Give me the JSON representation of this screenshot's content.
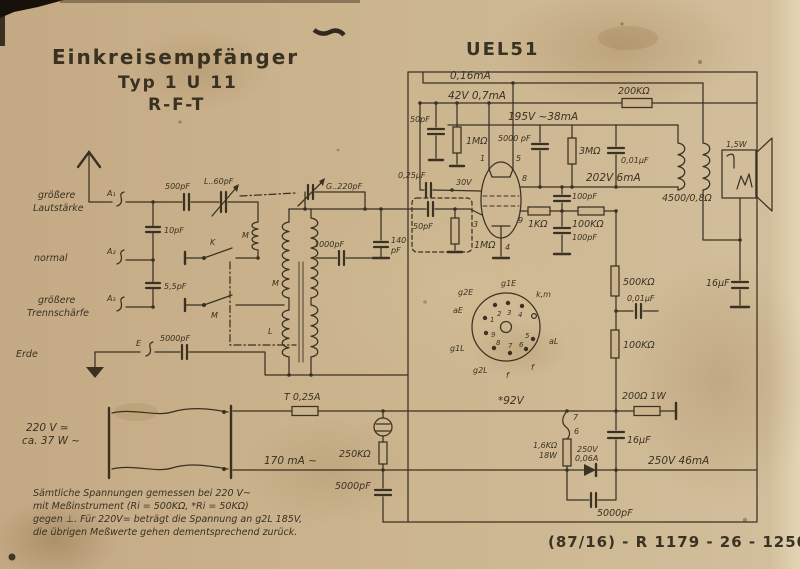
{
  "colors": {
    "paper": "#ccb58e",
    "ink": "#2e2719"
  },
  "title": {
    "line1": "Einkreisempfänger",
    "line2": "Typ 1 U  11",
    "line3": "R-F-T"
  },
  "tube_label": "UEL51",
  "input": {
    "a1": "A₁",
    "a1_desc1": "größere",
    "a1_desc2": "Lautstärke",
    "a2": "A₂",
    "a2_desc": "normal",
    "a3": "A₃",
    "a3_desc1": "größere",
    "a3_desc2": "Trennschärfe",
    "e": "E",
    "e_desc": "Erde",
    "c_a1": "500pF",
    "trim_l": "L..60pF",
    "c_10": "10pF",
    "c_55": "5,5pF",
    "c_erde": "5000pF"
  },
  "tuning": {
    "gang": "G..220pF",
    "c_1000": "1000pF",
    "c_140": "140",
    "c_140u": "pF",
    "coil_top": "M",
    "coil_mid": "M",
    "coil_low": "L",
    "sw_k": "K",
    "sw_m": "M"
  },
  "stage": {
    "rail_a": "0,16mA",
    "rail_b": "42V 0,7mA",
    "rail_c": "195V ~38mA",
    "rail_anode": "202V 6mA",
    "r200k": "200KΩ",
    "c50_top": "50pF",
    "r1m_top": "1MΩ",
    "c025": "0,25µF",
    "v30": "30V",
    "c50_grid": "50pF",
    "r1m_grid": "1MΩ",
    "pin1": "1",
    "pin3": "3",
    "pin4": "4",
    "pin5": "5",
    "pin8": "8",
    "pin9": "9",
    "r1k": "1KΩ",
    "r100k_h": "100KΩ",
    "c100_a": "100pF",
    "c100_b": "100pF",
    "c5000_screen": "5000 pF",
    "r3m": "3MΩ",
    "c001_a": "0,01µF"
  },
  "output": {
    "trafo": "4500/0,8Ω",
    "spk": "1,5W",
    "c16_a": "16µF",
    "r500k": "500KΩ",
    "c001_b": "0,01µF",
    "r100k_v": "100KΩ"
  },
  "socket": {
    "p1": "1",
    "p2": "2",
    "p3": "3",
    "p4": "4",
    "p5": "5",
    "p6": "6",
    "p7": "7",
    "p8": "8",
    "p9": "9",
    "g2E": "g2E",
    "g1E": "g1E",
    "km": "k,m",
    "aE": "aE",
    "aL": "aL",
    "g1L": "g1L",
    "g2L": "g2L",
    "f1": "f",
    "f2": "f"
  },
  "power": {
    "mains1": "220 V ≃",
    "mains2": "ca. 37 W ~",
    "fuse": "T 0,25A",
    "i170": "170 mA ~",
    "r250k": "250KΩ",
    "c5000_a": "5000pF",
    "v92": "*92V",
    "p7": "7",
    "p6": "6",
    "r16k1": "1,6KΩ",
    "r16k2": "18W",
    "rect1": "250V",
    "rect2": "0,06A",
    "c16_b": "16µF",
    "r200": "200Ω 1W",
    "v250": "250V 46mA",
    "c5000_b": "5000pF"
  },
  "notes": {
    "l1": "Sämtliche Spannungen gemessen bei 220 V~",
    "l2": "mit Meßinstrument (Ri = 500KΩ, *Ri = 50KΩ)",
    "l3": "gegen ⊥. Für 220V= beträgt die Spannung an g2L 185V,",
    "l4": "die übrigen Meßwerte gehen dementsprechend zurück."
  },
  "print_code": "(87/16) - R 1179  - 26  - 1250"
}
